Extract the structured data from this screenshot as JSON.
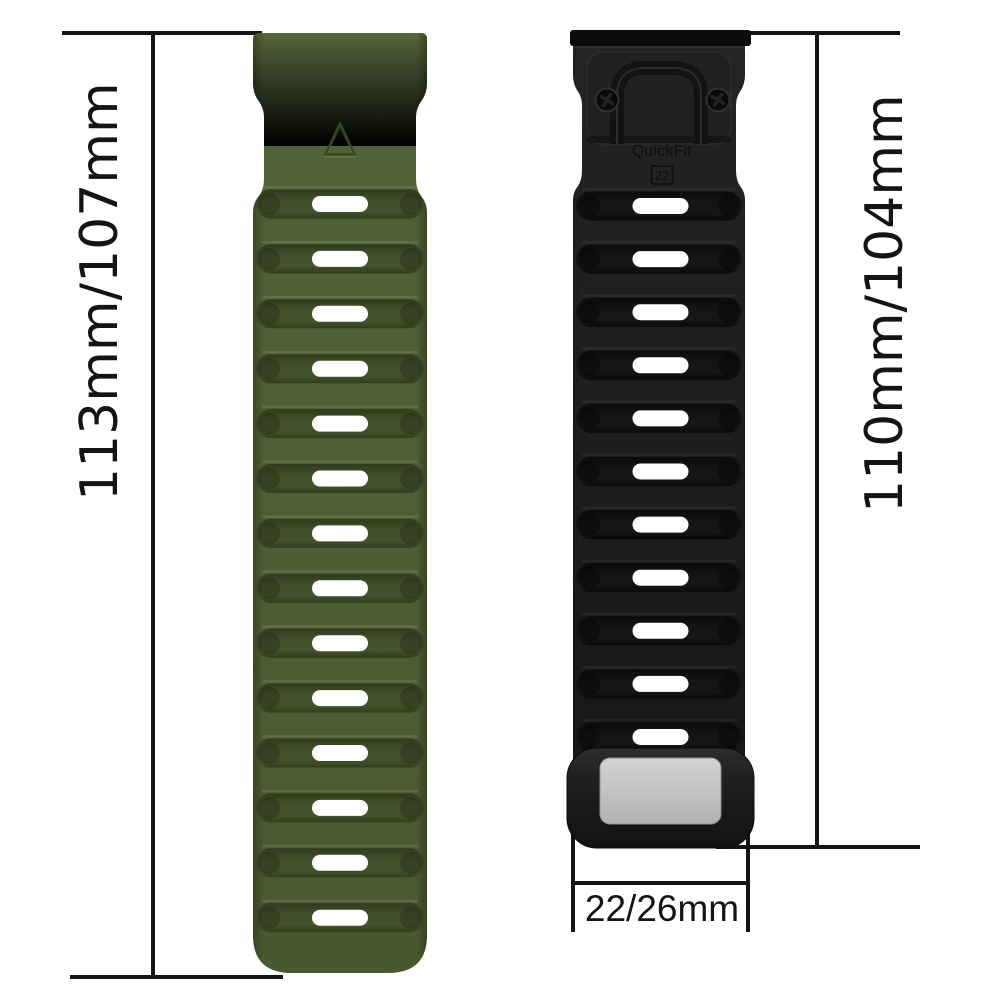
{
  "image_title": "Silicone watch band size diagram",
  "dimensions": {
    "left_label": "113mm/107mm",
    "right_label": "110mm/104mm",
    "bottom_label": "22/26mm"
  },
  "connector": {
    "brand": "QuickFit",
    "size": "22"
  },
  "straps": {
    "green": {
      "name": "Army green silicone strap",
      "slot_count": 14,
      "body_color": "#4e5e33",
      "groove_color": "#3c4a26",
      "slot_color": "#ffffff",
      "logo": "triangle"
    },
    "black": {
      "name": "Black silicone strap with QuickFit connector",
      "slot_count": 11,
      "body_color": "#1d1d1f",
      "groove_color": "#121214",
      "slot_color": "#ffffff",
      "keeper_color": "#c3c3c3"
    }
  },
  "annotation": {
    "line_color": "#141414",
    "text_color": "#141414"
  }
}
